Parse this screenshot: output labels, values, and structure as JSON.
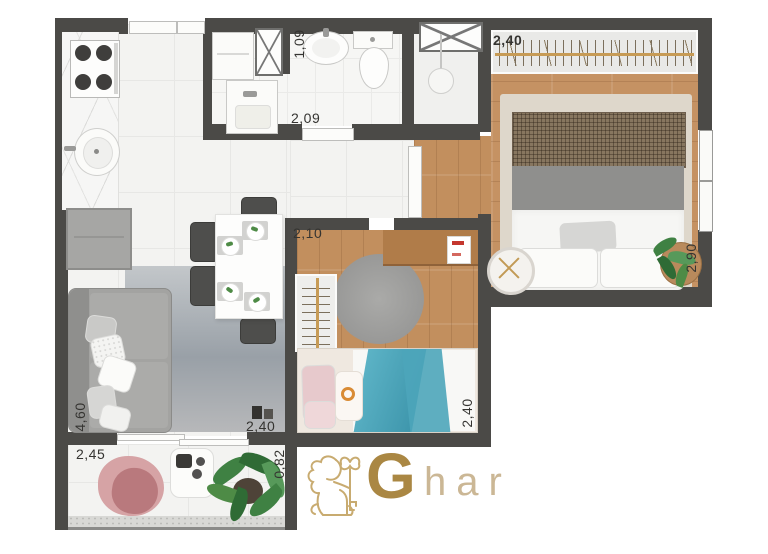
{
  "labels": {
    "bedroom1_closet_width": "2,40",
    "bedroom1_depth": "2,90",
    "service_width": "1,09",
    "bathroom_width": "2,09",
    "bedroom2_width": "2,10",
    "bedroom2_depth": "2,40",
    "living_depth": "4,60",
    "living_width": "2,40",
    "balcony_width": "2,45",
    "balcony_depth": "0,82"
  },
  "watermark": {
    "brand_initial": "G",
    "brand_rest": "har"
  },
  "colors": {
    "wall": "#4b4a47",
    "wood_floor": "#c28f5e",
    "brand_gold": "#c49a55",
    "blanket_blue": "#4da5ba",
    "armchair_pink": "#cb9396"
  }
}
